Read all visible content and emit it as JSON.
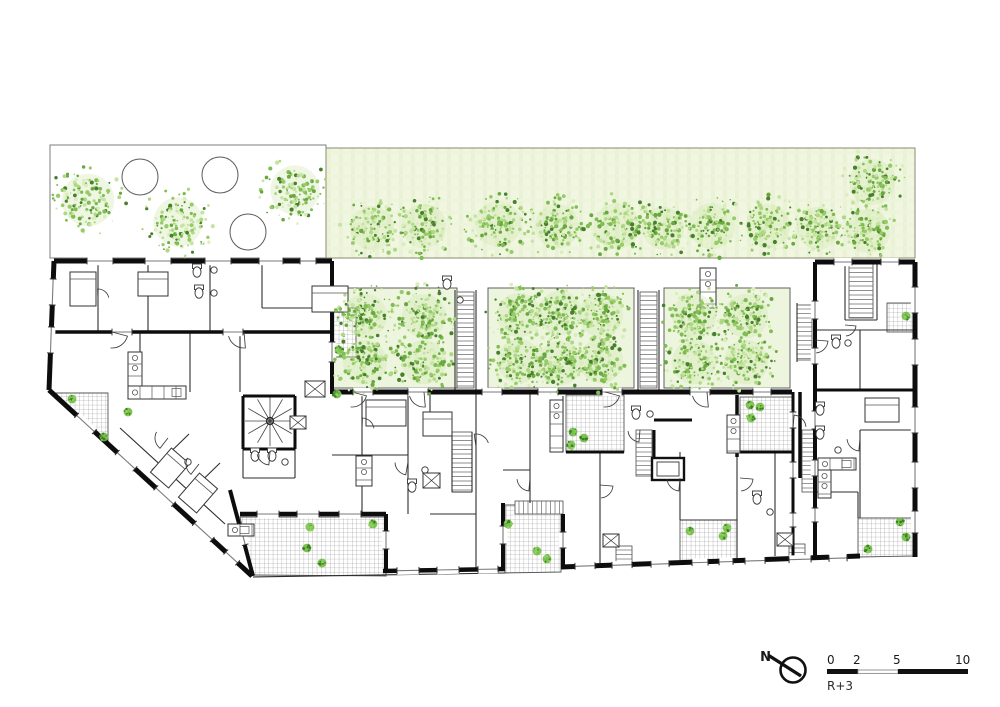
{
  "meta": {
    "drawing_type": "architectural floor plan",
    "floor_label": "R+3",
    "north_label": "N"
  },
  "scalebar": {
    "ticks": [
      "0",
      "2",
      "5",
      "10"
    ]
  },
  "colors": {
    "wall": "#0d0d0d",
    "partition": "#2e2e2e",
    "hatch_line": "#909090",
    "lawn_fill": "#f0f6e0",
    "lawn_streak": "#e4efd0",
    "courtyard_fill": "#eef5df",
    "border": "#666666",
    "foliage": [
      "#69a83f",
      "#7fbc52",
      "#96cb68",
      "#aed883",
      "#c6e4a1",
      "#daeebc"
    ],
    "foliage_dark": "#47802c",
    "shrub": "#6ebc3e",
    "text": "#1a1a1a"
  },
  "site": {
    "top_court": {
      "x": 50,
      "y": 145,
      "w": 276,
      "h": 113,
      "tree_circles": [
        [
          140,
          177,
          18
        ],
        [
          220,
          175,
          18
        ],
        [
          248,
          232,
          18
        ]
      ],
      "trees": [
        [
          88,
          200,
          32
        ],
        [
          178,
          222,
          30
        ],
        [
          295,
          190,
          30
        ]
      ]
    },
    "lawn": {
      "x": 326,
      "y": 148,
      "w": 589,
      "h": 110,
      "trees": [
        [
          372,
          228,
          27
        ],
        [
          424,
          226,
          27
        ],
        [
          498,
          224,
          28
        ],
        [
          557,
          226,
          27
        ],
        [
          617,
          226,
          28
        ],
        [
          663,
          228,
          26
        ],
        [
          712,
          226,
          28
        ],
        [
          768,
          226,
          27
        ],
        [
          818,
          228,
          26
        ],
        [
          868,
          231,
          27
        ],
        [
          872,
          182,
          28
        ]
      ]
    },
    "courtyards": [
      {
        "x": 332,
        "y": 288,
        "w": 125,
        "h": 100,
        "trees": [
          [
            365,
            316,
            27
          ],
          [
            424,
            316,
            27
          ],
          [
            365,
            362,
            27
          ],
          [
            424,
            362,
            27
          ]
        ]
      },
      {
        "x": 488,
        "y": 288,
        "w": 146,
        "h": 100,
        "trees": [
          [
            519,
            315,
            27
          ],
          [
            560,
            313,
            27
          ],
          [
            601,
            315,
            27
          ],
          [
            519,
            361,
            27
          ],
          [
            560,
            363,
            27
          ],
          [
            601,
            361,
            27
          ]
        ]
      },
      {
        "x": 664,
        "y": 288,
        "w": 126,
        "h": 100,
        "trees": [
          [
            694,
            316,
            27
          ],
          [
            746,
            316,
            27
          ],
          [
            694,
            362,
            27
          ],
          [
            746,
            362,
            27
          ]
        ]
      }
    ],
    "shrubs": [
      [
        72,
        399
      ],
      [
        104,
        437
      ],
      [
        128,
        412
      ],
      [
        310,
        527
      ],
      [
        307,
        548
      ],
      [
        322,
        563
      ],
      [
        373,
        524
      ],
      [
        339,
        350
      ],
      [
        508,
        524
      ],
      [
        537,
        551
      ],
      [
        547,
        559
      ],
      [
        573,
        432
      ],
      [
        584,
        438
      ],
      [
        571,
        445
      ],
      [
        750,
        405
      ],
      [
        760,
        407
      ],
      [
        751,
        418
      ],
      [
        690,
        531
      ],
      [
        727,
        528
      ],
      [
        723,
        536
      ],
      [
        900,
        522
      ],
      [
        906,
        537
      ],
      [
        868,
        549
      ],
      [
        906,
        316
      ],
      [
        337,
        394
      ]
    ]
  }
}
